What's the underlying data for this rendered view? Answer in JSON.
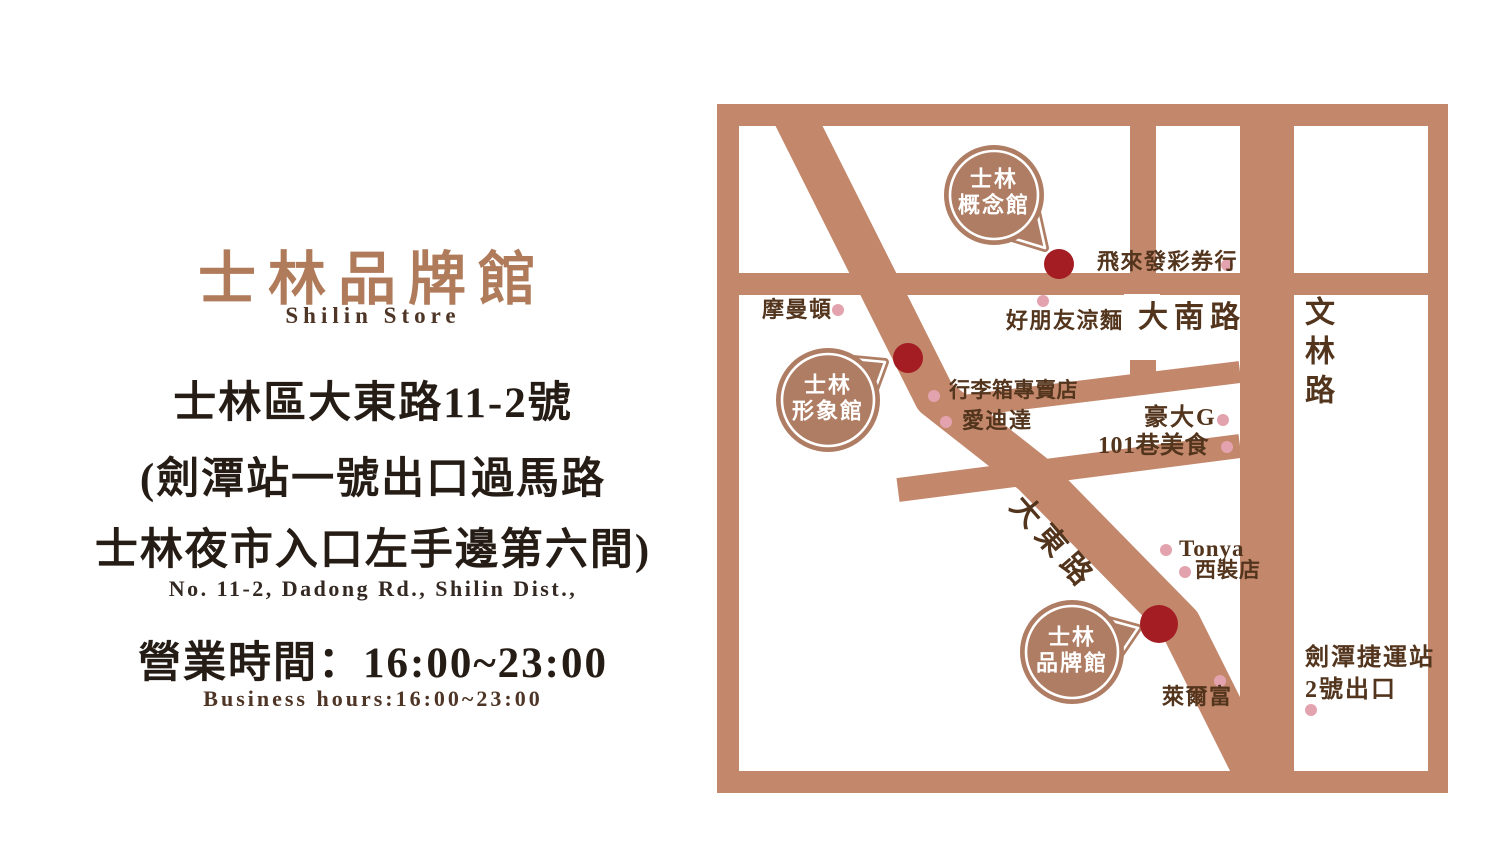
{
  "colors": {
    "road": "#c3886c",
    "bubble_fill": "#ae7d64",
    "store_dot_red": "#a31d23",
    "poi_dot_pink": "#e3a3ae",
    "map_label_text": "#53351d",
    "title_brown": "#b07b5a",
    "dark_text": "#251c15",
    "bubble_text": "#ffffff"
  },
  "left_panel": {
    "title": "士林品牌館",
    "subtitle": "Shilin Store",
    "address_line1": "士林區大東路11-2號",
    "address_line2": "(劍潭站一號出口過馬路",
    "address_line3": "士林夜市入口左手邊第六間)",
    "address_en": "No. 11-2, Dadong Rd., Shilin Dist.,",
    "hours_zh": "營業時間：16:00~23:00",
    "hours_en": "Business hours:16:00~23:00"
  },
  "map": {
    "streets": {
      "danan": "大南路",
      "wenlin": "文林路",
      "dadong": "大東路"
    },
    "bubbles": [
      {
        "line1": "士林",
        "line2": "概念館"
      },
      {
        "line1": "士林",
        "line2": "形象館"
      },
      {
        "line1": "士林",
        "line2": "品牌館"
      }
    ],
    "pois": [
      {
        "name": "飛來發彩券行"
      },
      {
        "name": "好朋友涼麵"
      },
      {
        "name": "摩曼頓"
      },
      {
        "name": "行李箱專賣店"
      },
      {
        "name": "愛迪達"
      },
      {
        "name": "豪大G"
      },
      {
        "name": "101巷美食"
      },
      {
        "name": "Tonya"
      },
      {
        "name": "西裝店"
      },
      {
        "name": "萊爾富"
      },
      {
        "name": "劍潭捷運站"
      },
      {
        "name": "2號出口"
      }
    ]
  }
}
